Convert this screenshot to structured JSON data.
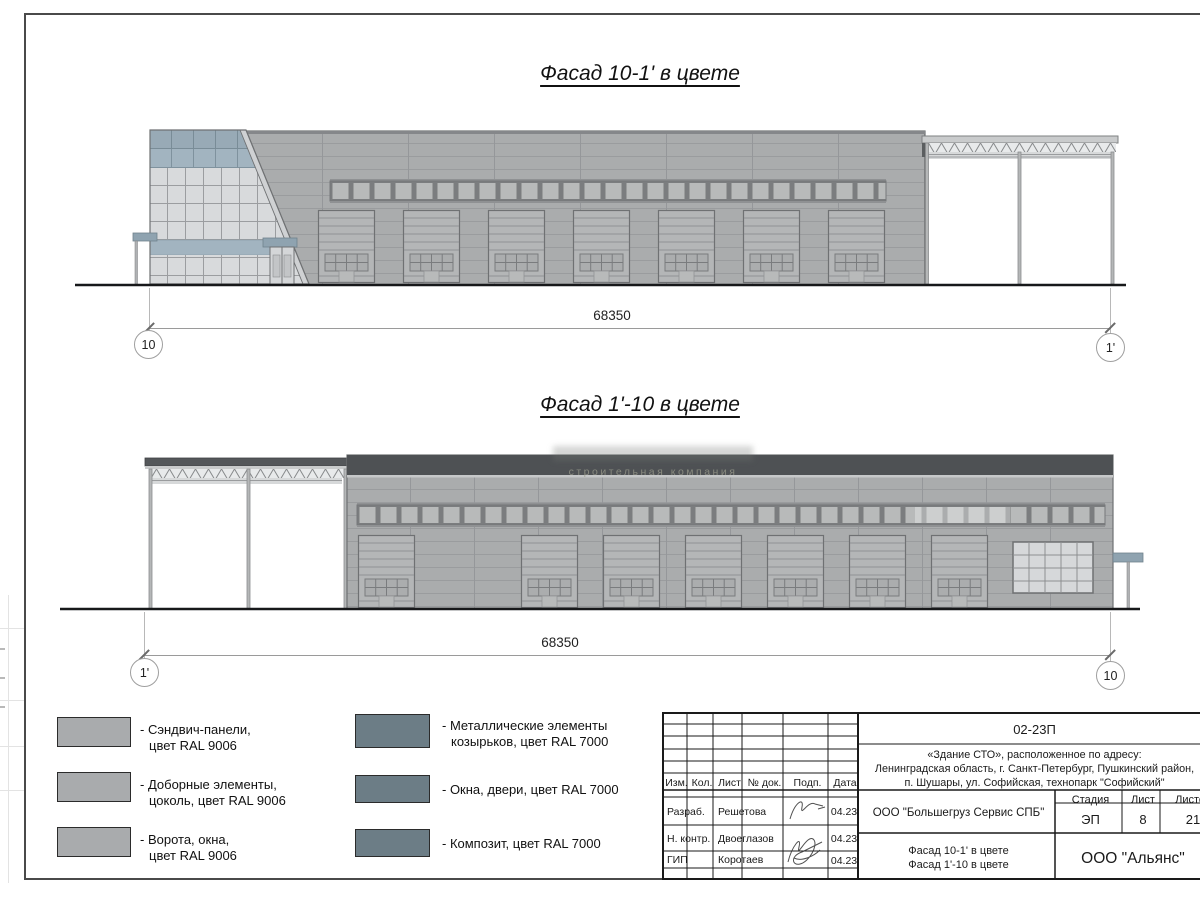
{
  "watermark": {
    "line": "строительная компания"
  },
  "facades": {
    "f1": {
      "title": "Фасад 10-1' в цвете",
      "dim": "68350",
      "axis_left": "10",
      "axis_right": "1'"
    },
    "f2": {
      "title": "Фасад 1'-10 в цвете",
      "dim": "68350",
      "axis_left": "1'",
      "axis_right": "10"
    }
  },
  "legend": {
    "ral9006_color": "#a9abad",
    "ral7000_color": "#6c7d86",
    "items": [
      {
        "l1": "- Сэндвич-панели,",
        "l2": "цвет RAL 9006",
        "color": "#a9abad"
      },
      {
        "l1": "- Доборные элементы,",
        "l2": "цоколь, цвет RAL 9006",
        "color": "#a9abad"
      },
      {
        "l1": "- Ворота, окна,",
        "l2": "цвет RAL 9006",
        "color": "#a9abad"
      },
      {
        "l1": "- Металлические элементы",
        "l2": "козырьков, цвет RAL 7000",
        "color": "#6c7d86"
      },
      {
        "l1": "- Окна, двери, цвет RAL 7000",
        "l2": "",
        "color": "#6c7d86"
      },
      {
        "l1": "- Композит, цвет RAL 7000",
        "l2": "",
        "color": "#6c7d86"
      }
    ]
  },
  "title_block": {
    "doc_number": "02-23П",
    "address_l1": "«Здание СТО», расположенное по адресу:",
    "address_l2": "Ленинградская область, г. Санкт-Петербург, Пушкинский район,",
    "address_l3": "п. Шушары, ул. Софийская, технопарк \"Софийский\"",
    "col_izm": "Изм.",
    "col_kol": "Кол.",
    "col_list": "Лист",
    "col_doc": "№ док.",
    "col_podp": "Подп.",
    "col_data": "Дата",
    "row1_role": "Разраб.",
    "row1_name": "Решетова",
    "row1_date": "04.23",
    "row2_role": "Н. контр.",
    "row2_name": "Двоеглазов",
    "row2_date": "04.23",
    "row3_role": "ГИП",
    "row3_name": "Коротаев",
    "row3_date": "04.23",
    "client": "ООО \"Большегруз Сервис СПБ\"",
    "sheet_title_l1": "Фасад 10-1' в цвете",
    "sheet_title_l2": "Фасад 1'-10 в цвете",
    "stage_label": "Стадия",
    "stage": "ЭП",
    "sheet_label": "Лист",
    "sheet_num": "8",
    "sheets_label": "Листов",
    "sheets_total": "21",
    "company": "ООО \"Альянс\""
  }
}
